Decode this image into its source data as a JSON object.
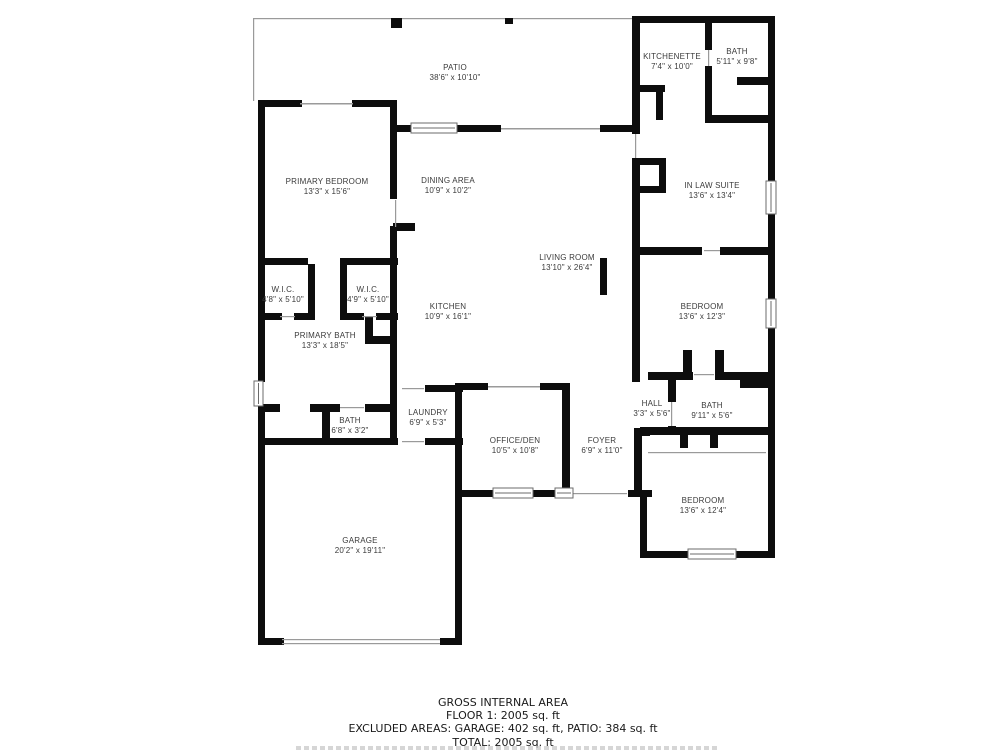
{
  "rooms": [
    {
      "id": "patio",
      "name": "PATIO",
      "dims": "38'6\" x 10'10\""
    },
    {
      "id": "kitchenette",
      "name": "KITCHENETTE",
      "dims": "7'4\" x 10'0\""
    },
    {
      "id": "bath-upper",
      "name": "BATH",
      "dims": "5'11\" x 9'8\""
    },
    {
      "id": "primary-bedroom",
      "name": "PRIMARY BEDROOM",
      "dims": "13'3\" x 15'6\""
    },
    {
      "id": "dining-area",
      "name": "DINING AREA",
      "dims": "10'9\" x 10'2\""
    },
    {
      "id": "in-law-suite",
      "name": "IN LAW SUITE",
      "dims": "13'6\" x 13'4\""
    },
    {
      "id": "living-room",
      "name": "LIVING ROOM",
      "dims": "13'10\" x 26'4\""
    },
    {
      "id": "wic-left",
      "name": "W.I.C.",
      "dims": "4'8\" x 5'10\""
    },
    {
      "id": "wic-right",
      "name": "W.I.C.",
      "dims": "4'9\" x 5'10\""
    },
    {
      "id": "kitchen",
      "name": "KITCHEN",
      "dims": "10'9\" x 16'1\""
    },
    {
      "id": "bedroom-middle",
      "name": "BEDROOM",
      "dims": "13'6\" x 12'3\""
    },
    {
      "id": "primary-bath",
      "name": "PRIMARY BATH",
      "dims": "13'3\" x 18'5\""
    },
    {
      "id": "hall",
      "name": "HALL",
      "dims": "3'3\" x 5'6\""
    },
    {
      "id": "bath-hall",
      "name": "BATH",
      "dims": "9'11\" x 5'6\""
    },
    {
      "id": "bath-small",
      "name": "BATH",
      "dims": "6'8\" x 3'2\""
    },
    {
      "id": "laundry",
      "name": "LAUNDRY",
      "dims": "6'9\" x 5'3\""
    },
    {
      "id": "office-den",
      "name": "OFFICE/DEN",
      "dims": "10'5\" x 10'8\""
    },
    {
      "id": "foyer",
      "name": "FOYER",
      "dims": "6'9\" x 11'0\""
    },
    {
      "id": "bedroom-lower",
      "name": "BEDROOM",
      "dims": "13'6\" x 12'4\""
    },
    {
      "id": "garage",
      "name": "GARAGE",
      "dims": "20'2\" x 19'11\""
    }
  ],
  "footer": {
    "line1": "GROSS INTERNAL AREA",
    "line2": "FLOOR 1: 2005 sq. ft",
    "line3": "EXCLUDED AREAS: GARAGE: 402 sq. ft, PATIO: 384 sq. ft",
    "line4": "TOTAL: 2005 sq. ft"
  },
  "colors": {
    "wall": "#0d0d0d",
    "thin_line": "#9a9a9a",
    "label_text": "#3b3b3b",
    "footer_text": "#1a1a1a",
    "window_frame": "#6b6b6b"
  }
}
